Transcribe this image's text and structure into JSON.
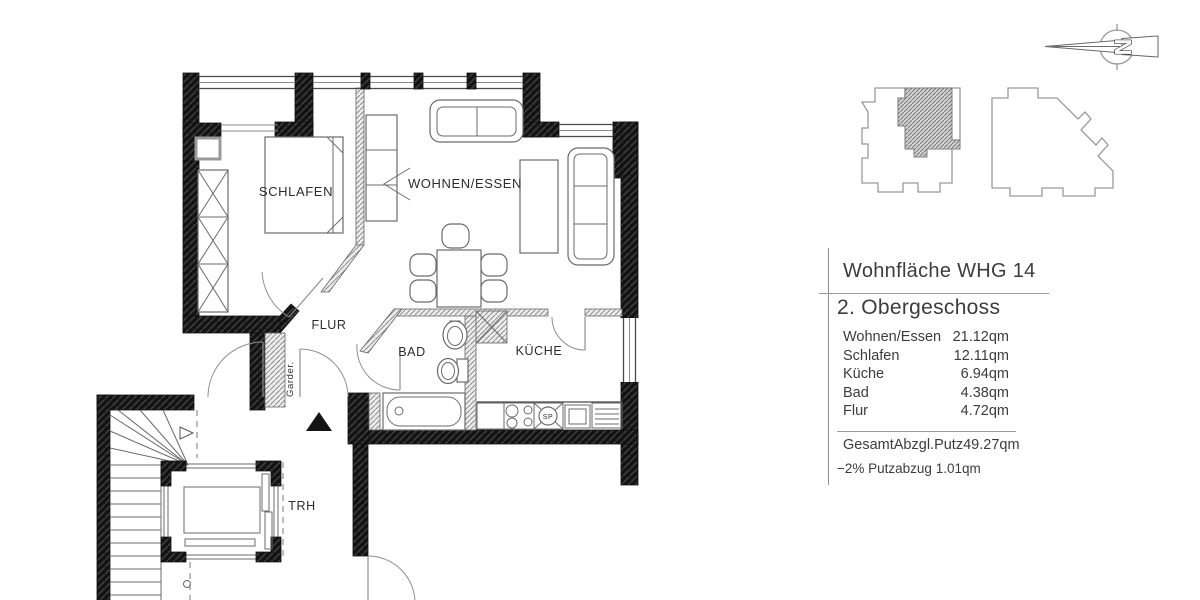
{
  "floor_plan": {
    "room_labels": {
      "schlafen": "SCHLAFEN",
      "wohnen_essen": "WOHNEN/ESSEN",
      "flur": "FLUR",
      "bad": "BAD",
      "kueche": "KÜCHE",
      "trh": "TRH",
      "garderobe": "Garder.",
      "sink": "SP"
    },
    "colors": {
      "wall": "#131313",
      "thin_line": "#6b6b6b",
      "hatch": "#8f8f8f"
    }
  },
  "compass": {
    "north_label": "N"
  },
  "area_panel": {
    "title": "Wohnfläche WHG 14",
    "floor": "2. Obergeschoss",
    "rows": [
      {
        "label": "Wohnen/Essen",
        "value": "21.12qm"
      },
      {
        "label": "Schlafen",
        "value": "12.11qm"
      },
      {
        "label": "Küche",
        "value": "6.94qm"
      },
      {
        "label": "Bad",
        "value": "4.38qm"
      },
      {
        "label": "Flur",
        "value": "4.72qm"
      }
    ],
    "total": {
      "label": "Gesamt",
      "method": "Abzgl.Putz",
      "value": "49.27qm"
    },
    "note": "−2% Putzabzug 1.01qm"
  }
}
